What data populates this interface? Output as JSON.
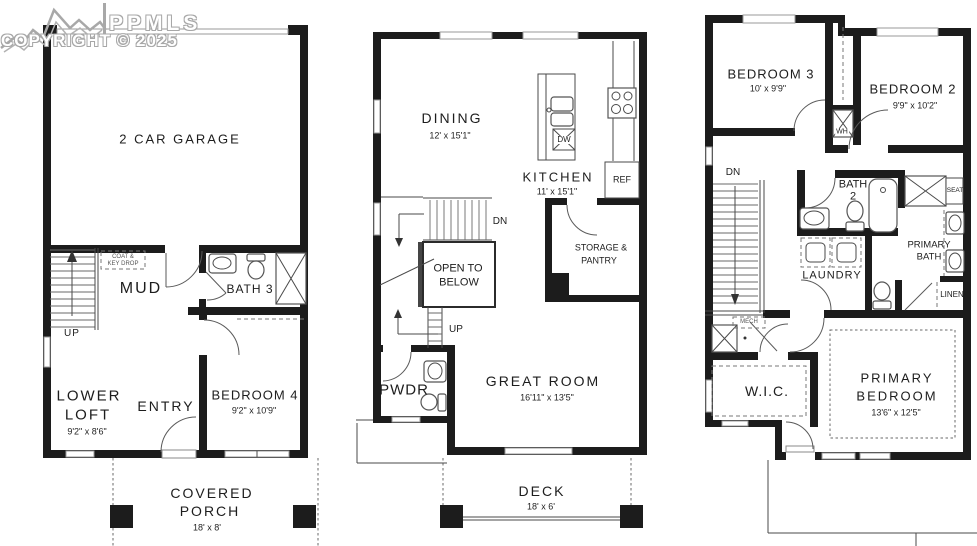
{
  "watermark": {
    "brand": "PPMLS",
    "copyright": "COPYRIGHT © 2025"
  },
  "lower_level": {
    "garage": {
      "name": "2 CAR GARAGE"
    },
    "coat_key_drop": {
      "line1": "COAT &",
      "line2": "KEY DROP"
    },
    "mud": {
      "name": "MUD"
    },
    "bath3": {
      "name": "BATH 3"
    },
    "stairs": {
      "up": "UP"
    },
    "lower_loft": {
      "line1": "LOWER",
      "line2": "LOFT",
      "dims": "9'2\" x 8'6\""
    },
    "entry": {
      "name": "ENTRY"
    },
    "bedroom4": {
      "name": "BEDROOM 4",
      "dims": "9'2\" x 10'9\""
    },
    "covered_porch": {
      "line1": "COVERED",
      "line2": "PORCH",
      "dims": "18' x 8'"
    }
  },
  "main_level": {
    "dining": {
      "name": "DINING",
      "dims": "12' x 15'1\""
    },
    "kitchen": {
      "name": "KITCHEN",
      "dims": "11' x 15'1\""
    },
    "island": {
      "dw": "DW"
    },
    "ref": {
      "label": "REF"
    },
    "stairs": {
      "dn": "DN",
      "up": "UP"
    },
    "open_to_below": {
      "line1": "OPEN TO",
      "line2": "BELOW"
    },
    "storage_pantry": {
      "line1": "STORAGE &",
      "line2": "PANTRY"
    },
    "pwdr": {
      "name": "PWDR"
    },
    "great_room": {
      "name": "GREAT ROOM",
      "dims": "16'11\" x 13'5\""
    },
    "deck": {
      "name": "DECK",
      "dims": "18' x 6'"
    }
  },
  "upper_level": {
    "bedroom3": {
      "name": "BEDROOM 3",
      "dims": "10' x 9'9\""
    },
    "bedroom2": {
      "name": "BEDROOM 2",
      "dims": "9'9\" x 10'2\""
    },
    "water_heater": {
      "label": "WH"
    },
    "stairs": {
      "dn": "DN"
    },
    "bath2": {
      "line1": "BATH",
      "line2": "2"
    },
    "shower_seat": {
      "label": "SEAT"
    },
    "primary_bath": {
      "line1": "PRIMARY",
      "line2": "BATH"
    },
    "laundry": {
      "name": "LAUNDRY"
    },
    "linen": {
      "name": "LINEN"
    },
    "mech": {
      "name": "MECH"
    },
    "wic": {
      "name": "W.I.C."
    },
    "primary_bedroom": {
      "line1": "PRIMARY",
      "line2": "BEDROOM",
      "dims": "13'6\" x 12'5\""
    }
  }
}
